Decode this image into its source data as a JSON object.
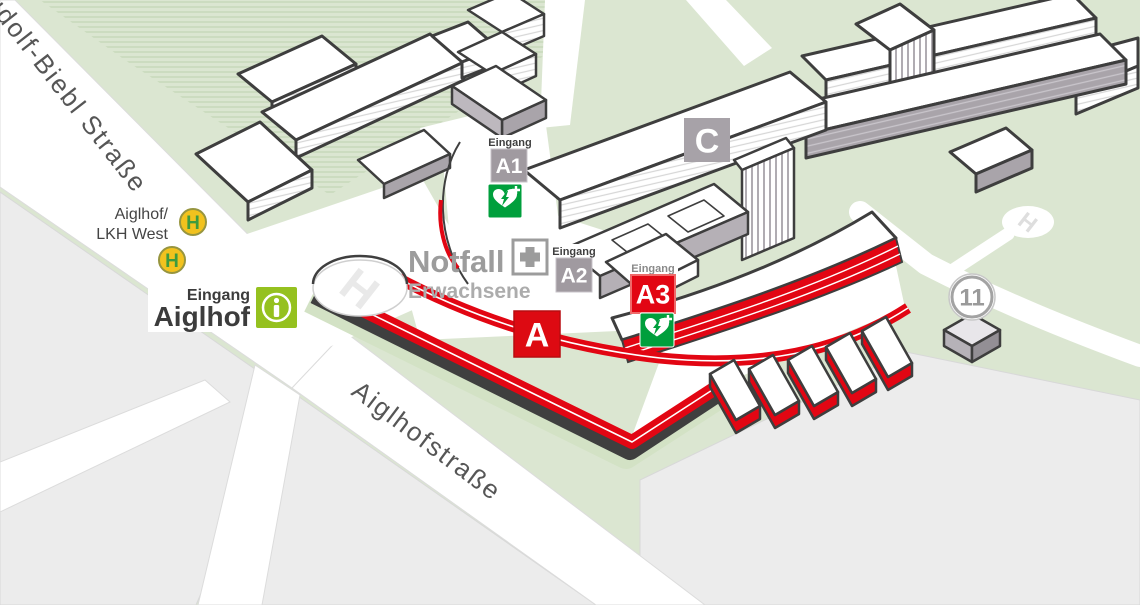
{
  "map": {
    "streets": {
      "rudolf_biebl": "Rudolf-Biebl Straße",
      "aiglhofstrasse": "Aiglhofstraße"
    },
    "bus_stop": {
      "line1": "Aiglhof/",
      "line2": "LKH West",
      "symbol": "H"
    },
    "entrance_main": {
      "prefix": "Eingang",
      "name": "Aiglhof"
    },
    "emergency": {
      "title": "Notfall",
      "subtitle": "Erwachsene"
    },
    "entrances": [
      {
        "prefix": "Eingang",
        "label": "A1"
      },
      {
        "prefix": "Eingang",
        "label": "A2"
      },
      {
        "prefix": "Eingang",
        "label": "A3"
      }
    ],
    "buildings": {
      "a": "A",
      "c": "C",
      "eleven": "11"
    },
    "helipad": {
      "symbol": "H"
    },
    "colors": {
      "accent_red": "#e20613",
      "label_gray": "#a09aa0",
      "entrance_green": "#95c11f",
      "defib_green": "#009f3c",
      "bus_yellow": "#f2c21e",
      "bus_h_green": "#3e9b3e",
      "ground_green": "#dbe6d1",
      "block_gray": "#ececec"
    }
  }
}
